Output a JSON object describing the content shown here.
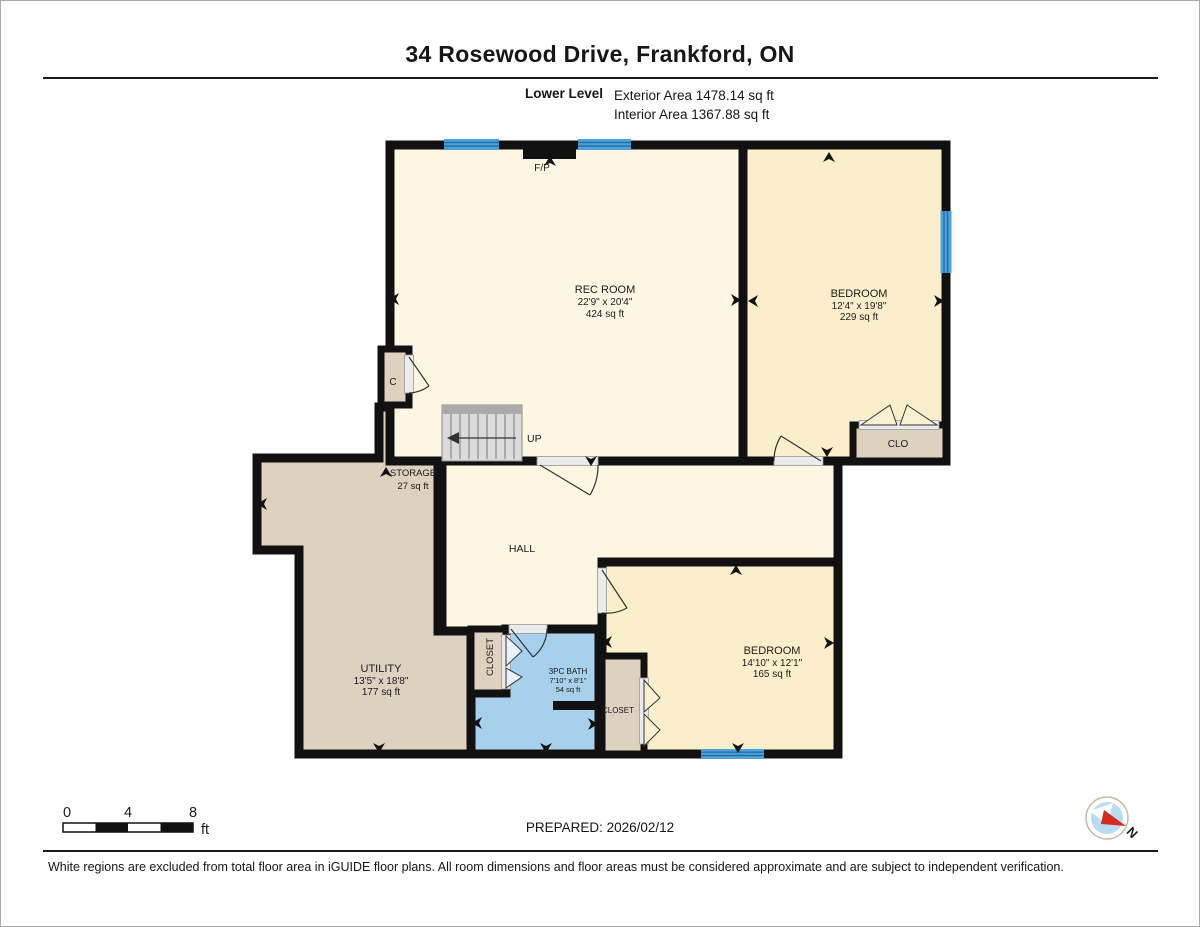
{
  "header": {
    "title": "34 Rosewood Drive, Frankford, ON",
    "level": "Lower Level",
    "exterior": "Exterior Area 1478.14 sq ft",
    "interior": "Interior Area 1367.88 sq ft"
  },
  "plan": {
    "rec": {
      "name": "REC ROOM",
      "dims": "22'9\" x 20'4\"",
      "area": "424 sq ft"
    },
    "bedroom1": {
      "name": "BEDROOM",
      "dims": "12'4\" x 19'8\"",
      "area": "229 sq ft"
    },
    "bedroom2": {
      "name": "BEDROOM",
      "dims": "14'10\" x 12'1\"",
      "area": "165 sq ft"
    },
    "utility": {
      "name": "UTILITY",
      "dims": "13'5\" x 18'8\"",
      "area": "177 sq ft"
    },
    "storage": {
      "name": "STORAGE",
      "area": "27 sq ft"
    },
    "bath": {
      "name": "3PC BATH",
      "dims": "7'10\" x 8'1\"",
      "area": "54 sq ft"
    },
    "hall": "HALL",
    "closet1": "CLOSET",
    "closet2": "CLOSET",
    "clo": "CLO",
    "c_closet": "C",
    "fireplace": "F/P",
    "stairs_up": "UP"
  },
  "footer": {
    "scale": {
      "zero": "0",
      "four": "4",
      "eight": "8",
      "unit": "ft"
    },
    "prepared": "PREPARED: 2026/02/12",
    "compass": "N"
  },
  "disclaimer": "White regions are excluded from total floor area in iGUIDE floor plans. All room dimensions and floor areas must be considered approximate and are subject to independent verification.",
  "colors": {
    "wall": "#111111",
    "room_cream": "#FDF6E3",
    "bedroom_cream": "#FBEFCB",
    "tan": "#DDD1C0",
    "bath_blue": "#A6D0EC",
    "window_blue": "#4DA3D8",
    "window_stripe": "#1F6FA8",
    "compass_red": "#D42B1E",
    "compass_blue": "#BADCF2"
  }
}
